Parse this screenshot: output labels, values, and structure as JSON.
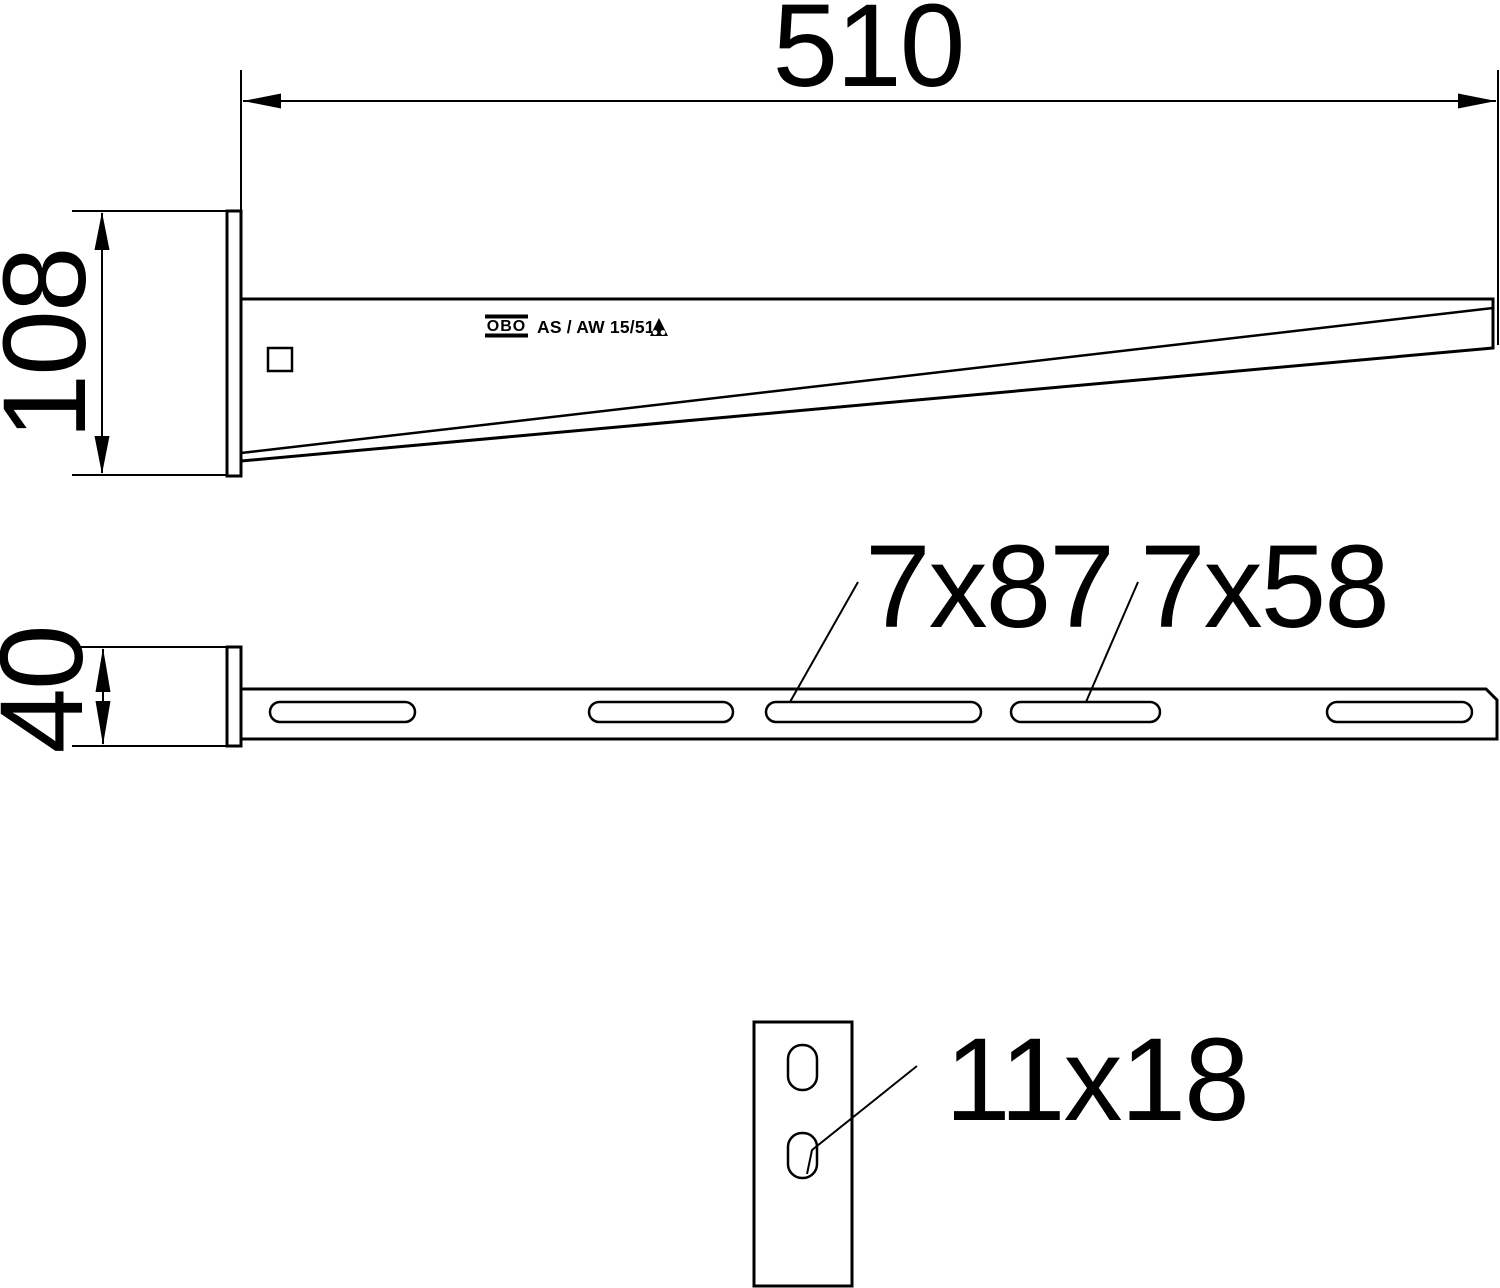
{
  "drawing": {
    "title": "Wall and support bracket technical drawing",
    "colors": {
      "ink": "#000000",
      "background": "#ffffff"
    },
    "side_view": {
      "width_dim": "510",
      "height_dim": "108"
    },
    "plan_view": {
      "width_dim": "40",
      "slot_long_label": "7x87",
      "slot_short_label": "7x58"
    },
    "front_plate_view": {
      "hole_label": "11x18"
    },
    "marking": {
      "brand": "OBO",
      "model": "AS / AW 15/51"
    }
  }
}
